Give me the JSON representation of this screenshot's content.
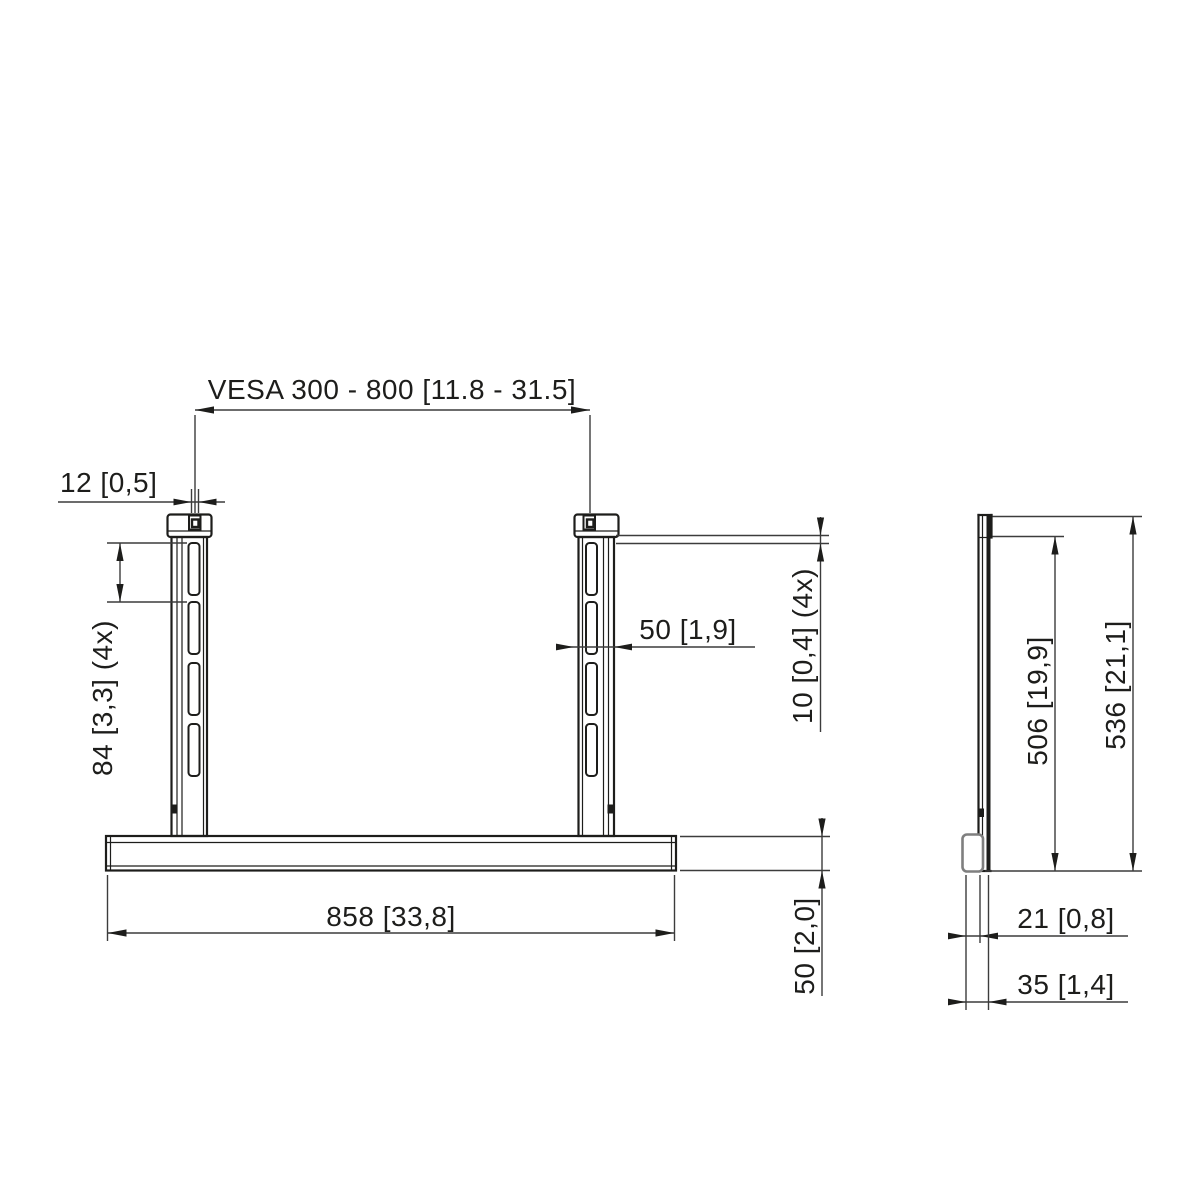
{
  "drawing_type": "dimensioned technical drawing, front and side view of TV stand base with two VESA columns",
  "front_view": {
    "vesa_range": "VESA 300 - 800 [11.8 - 31.5]",
    "top_tab_width": "12 [0,5]",
    "slot_pitch": "84 [3,3] (4x)",
    "column_width": "50 [1,9]",
    "slot_inset": "10 [0,4] (4x)",
    "base_width": "858 [33,8]",
    "base_height": "50 [2,0]"
  },
  "side_view": {
    "column_height": "506 [19,9]",
    "total_height": "536 [21,1]",
    "foot_depth": "21 [0,8]",
    "base_depth": "35 [1,4]"
  },
  "colors": {
    "line": "#1d1d1b",
    "dimension_line": "#3c3c3c",
    "foot_outline": "#7f7f7f",
    "background": "#ffffff"
  }
}
